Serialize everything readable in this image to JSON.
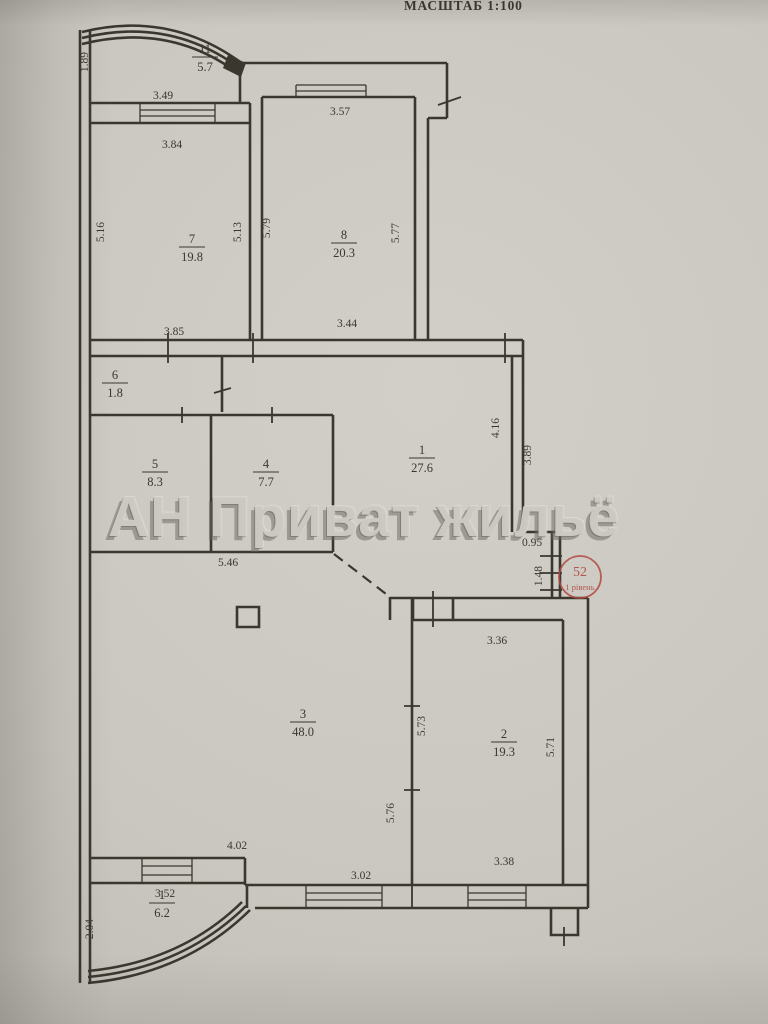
{
  "header": {
    "title": "МАСШТАБ 1:100"
  },
  "watermark": {
    "text": "АН Приват жильё"
  },
  "stamp": {
    "number": "52",
    "level": "1 рівень"
  },
  "colors": {
    "ink": "#3a372f",
    "paper": "#cac7c0",
    "stamp": "#b0493f"
  },
  "plan": {
    "rooms": [
      {
        "number": "11",
        "area": "5.7",
        "x": 205,
        "y": 57
      },
      {
        "number": "7",
        "area": "19.8",
        "x": 192,
        "y": 247
      },
      {
        "number": "8",
        "area": "20.3",
        "x": 344,
        "y": 243
      },
      {
        "number": "6",
        "area": "1.8",
        "x": 115,
        "y": 383
      },
      {
        "number": "5",
        "area": "8.3",
        "x": 155,
        "y": 472
      },
      {
        "number": "4",
        "area": "7.7",
        "x": 266,
        "y": 472
      },
      {
        "number": "1",
        "area": "27.6",
        "x": 422,
        "y": 458
      },
      {
        "number": "3",
        "area": "48.0",
        "x": 303,
        "y": 722
      },
      {
        "number": "2",
        "area": "19.3",
        "x": 504,
        "y": 742
      },
      {
        "number": "1",
        "area": "6.2",
        "x": 162,
        "y": 903
      }
    ],
    "dimensions": [
      {
        "text": "1.89",
        "x": 88,
        "y": 62,
        "rotate": -90
      },
      {
        "text": "3.49",
        "x": 163,
        "y": 99
      },
      {
        "text": "3.84",
        "x": 172,
        "y": 148
      },
      {
        "text": "3.57",
        "x": 340,
        "y": 115
      },
      {
        "text": "5.16",
        "x": 104,
        "y": 232,
        "rotate": -90
      },
      {
        "text": "5.13",
        "x": 241,
        "y": 232,
        "rotate": -90
      },
      {
        "text": "5.79",
        "x": 270,
        "y": 228,
        "rotate": -90
      },
      {
        "text": "5.77",
        "x": 399,
        "y": 233,
        "rotate": -90
      },
      {
        "text": "3.85",
        "x": 174,
        "y": 335
      },
      {
        "text": "3.44",
        "x": 347,
        "y": 327
      },
      {
        "text": "4.16",
        "x": 499,
        "y": 428,
        "rotate": -90
      },
      {
        "text": "3.89",
        "x": 531,
        "y": 455,
        "rotate": -90
      },
      {
        "text": "0.95",
        "x": 532,
        "y": 546
      },
      {
        "text": "1.48",
        "x": 542,
        "y": 576,
        "rotate": -90
      },
      {
        "text": "5.46",
        "x": 228,
        "y": 566
      },
      {
        "text": "3.36",
        "x": 497,
        "y": 644
      },
      {
        "text": "5.73",
        "x": 425,
        "y": 726,
        "rotate": -90
      },
      {
        "text": "5.71",
        "x": 554,
        "y": 747,
        "rotate": -90
      },
      {
        "text": "5.76",
        "x": 394,
        "y": 813,
        "rotate": -90
      },
      {
        "text": "4.02",
        "x": 237,
        "y": 849
      },
      {
        "text": "3.02",
        "x": 361,
        "y": 879
      },
      {
        "text": "3.38",
        "x": 504,
        "y": 865
      },
      {
        "text": "3.52",
        "x": 165,
        "y": 897
      },
      {
        "text": "2.04",
        "x": 93,
        "y": 929,
        "rotate": -90
      }
    ]
  }
}
